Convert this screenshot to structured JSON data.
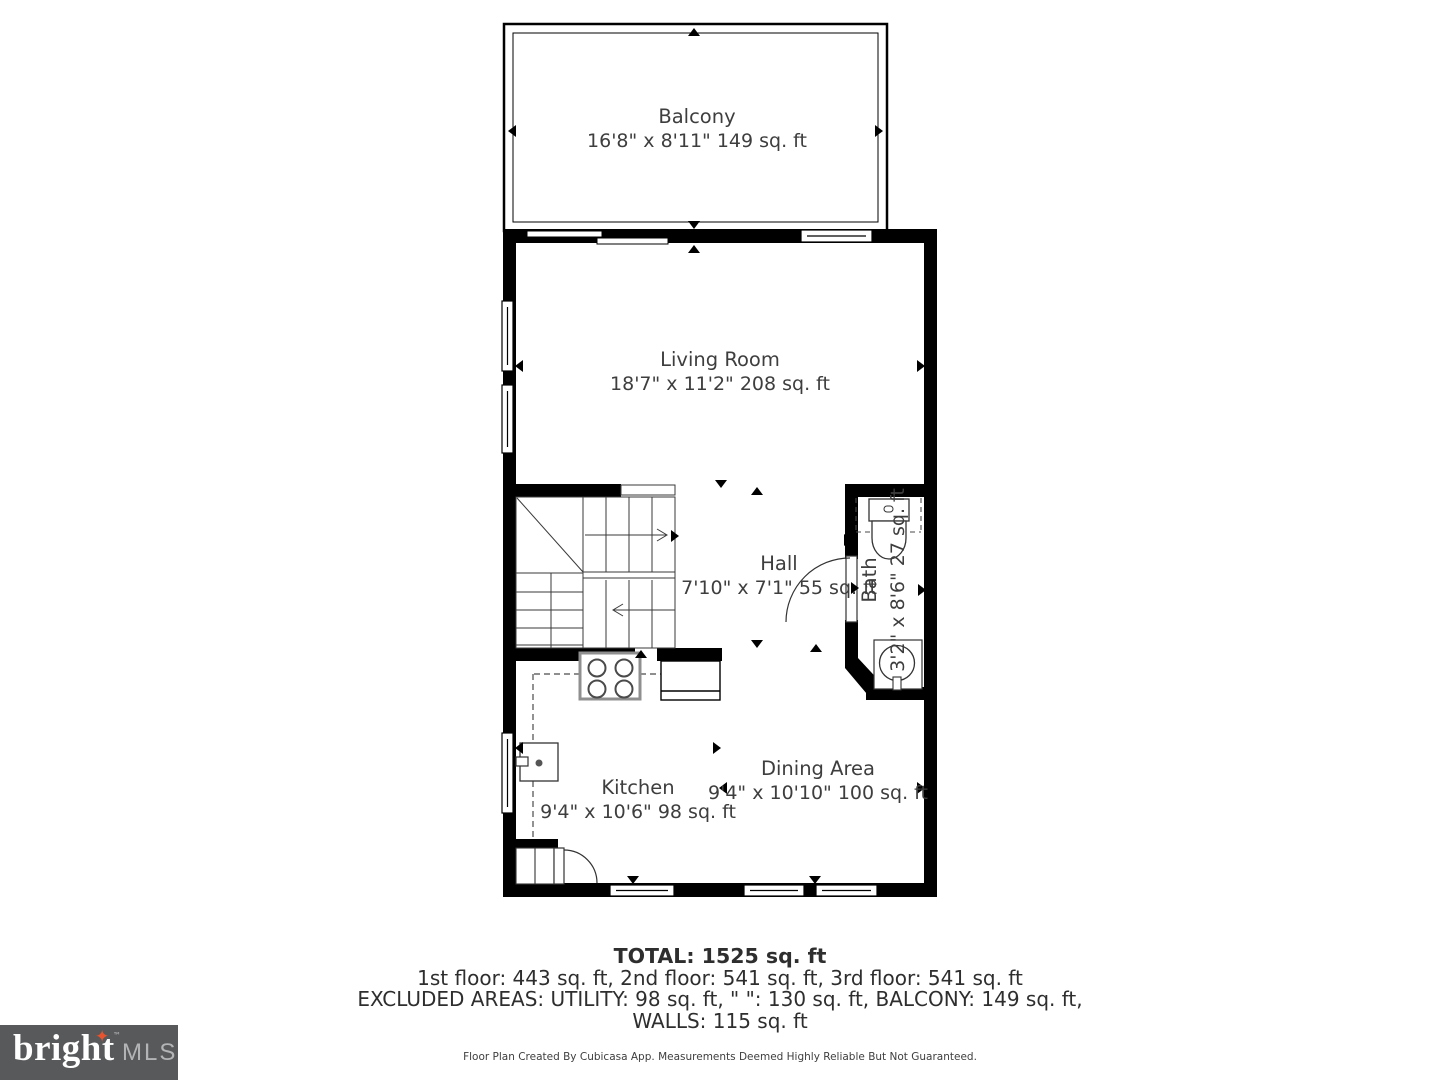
{
  "rooms": {
    "balcony": {
      "name": "Balcony",
      "dims": "16'8\" x 8'11\" 149 sq. ft"
    },
    "living_room": {
      "name": "Living Room",
      "dims": "18'7\" x 11'2\" 208 sq. ft"
    },
    "hall": {
      "name": "Hall",
      "dims": "7'10\" x 7'1\" 55 sq. ft"
    },
    "bath": {
      "name": "Bath",
      "dims": "3'2\" x 8'6\" 27 sq. ft"
    },
    "kitchen": {
      "name": "Kitchen",
      "dims": "9'4\" x 10'6\" 98 sq. ft"
    },
    "dining_area": {
      "name": "Dining Area",
      "dims": "9'4\" x 10'10\" 100 sq. ft"
    }
  },
  "summary": {
    "total": "TOTAL: 1525 sq. ft",
    "floors": "1st floor: 443 sq. ft, 2nd floor: 541 sq. ft, 3rd floor: 541 sq. ft",
    "excluded": "EXCLUDED AREAS: UTILITY: 98 sq. ft, \" \": 130 sq. ft, BALCONY: 149 sq. ft,",
    "walls": "WALLS: 115 sq. ft",
    "disclaimer": "Floor Plan Created By Cubicasa App. Measurements Deemed Highly Reliable But Not Guaranteed."
  },
  "branding": {
    "logo_word": "bright",
    "logo_suffix": "MLS",
    "trademark": "™",
    "star_glyph": "✦",
    "logo_bg": "#58595b",
    "star_color": "#e8542d"
  }
}
